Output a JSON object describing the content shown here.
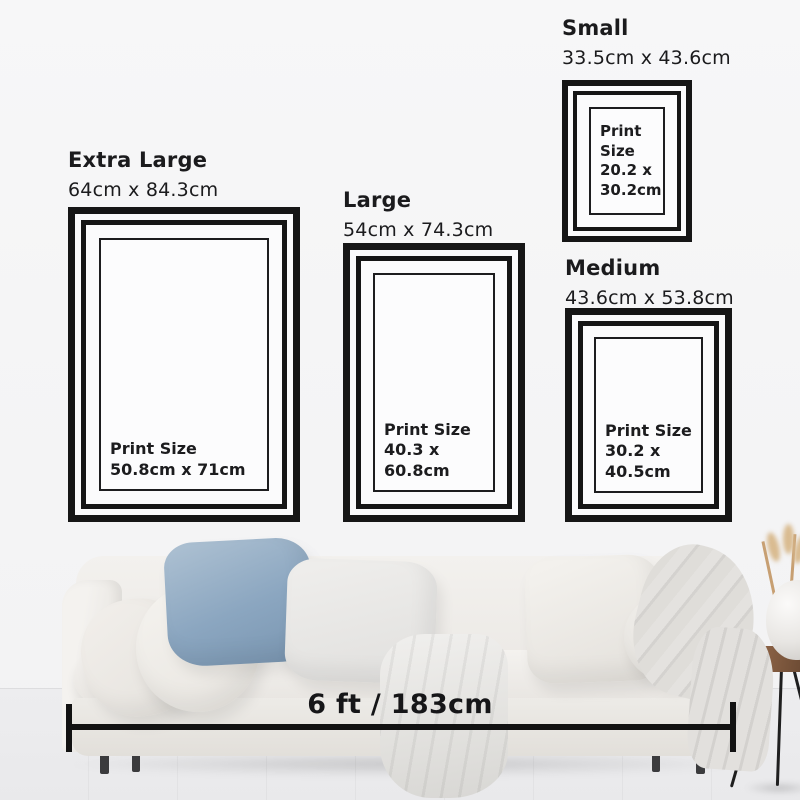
{
  "frames": [
    {
      "name": "Extra Large",
      "size": "64cm x 84.3cm",
      "print_label": "Print Size",
      "print_size": "50.8cm x 71cm"
    },
    {
      "name": "Large",
      "size": "54cm x 74.3cm",
      "print_label": "Print Size",
      "print_size": "40.3 x 60.8cm"
    },
    {
      "name": "Small",
      "size": "33.5cm x 43.6cm",
      "print_label": "Print Size",
      "print_size": "20.2 x 30.2cm"
    },
    {
      "name": "Medium",
      "size": "43.6cm x 53.8cm",
      "print_label": "Print Size",
      "print_size": "30.2 x 40.5cm"
    }
  ],
  "measurement": {
    "label": "6 ft / 183cm"
  },
  "colors": {
    "frame_black": "#161616",
    "text": "#1b1b1d",
    "annotation": "#121212",
    "wall": "#f5f5f6",
    "floor": "#ebebed",
    "sofa_cream": "#efede9",
    "pillow_blue": "#8ba6c0",
    "stool_wood": "#7d5a3e"
  }
}
